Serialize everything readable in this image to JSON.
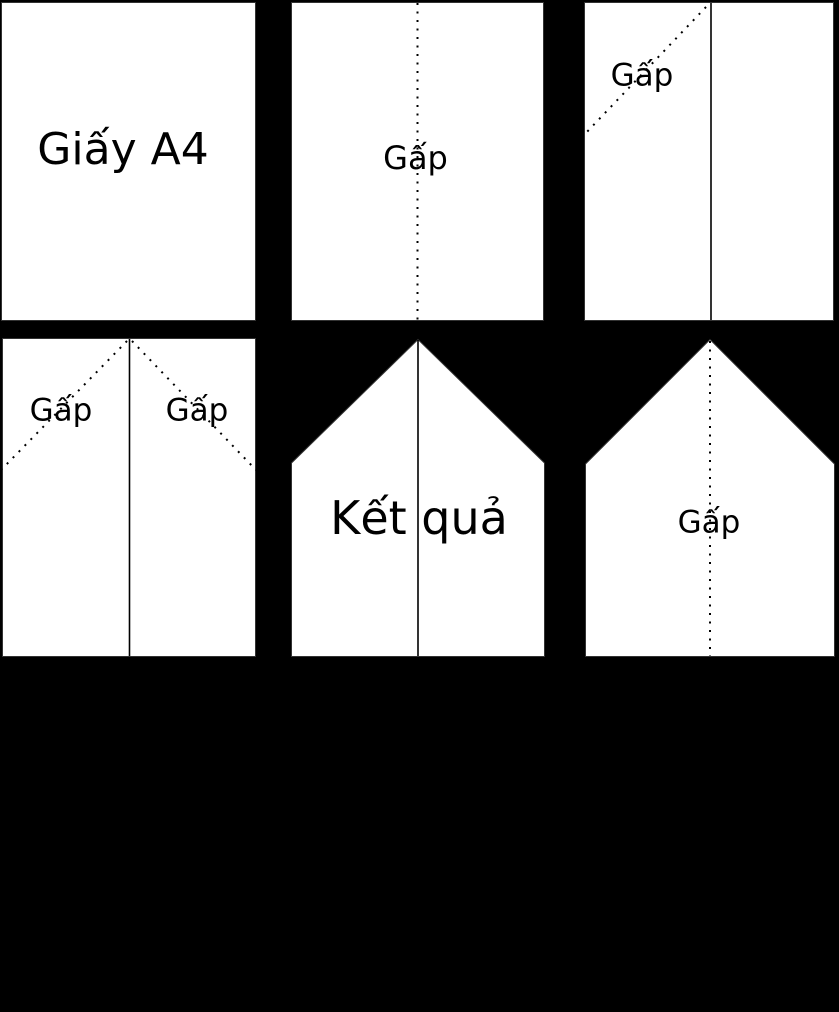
{
  "diagram": {
    "description_labels": {
      "paper": "Giấy A4",
      "fold": "Gấp",
      "result": "Kết quả"
    },
    "colors": {
      "background": "#000000",
      "paper_fill": "#ffffff",
      "paper_border": "#333333",
      "fold_line": "#000000",
      "text": "#000000"
    },
    "panels": [
      {
        "name": "step-1-a4-paper",
        "label": "Giấy A4"
      },
      {
        "name": "step-2-fold-center",
        "label": "Gấp"
      },
      {
        "name": "step-3-fold-left-corner",
        "label": "Gấp"
      },
      {
        "name": "step-4-fold-both-corners",
        "label_left": "Gấp",
        "label_right": "Gấp"
      },
      {
        "name": "step-5-result",
        "label": "Kết quả"
      },
      {
        "name": "step-6-fold-result-center",
        "label": "Gấp"
      }
    ]
  }
}
